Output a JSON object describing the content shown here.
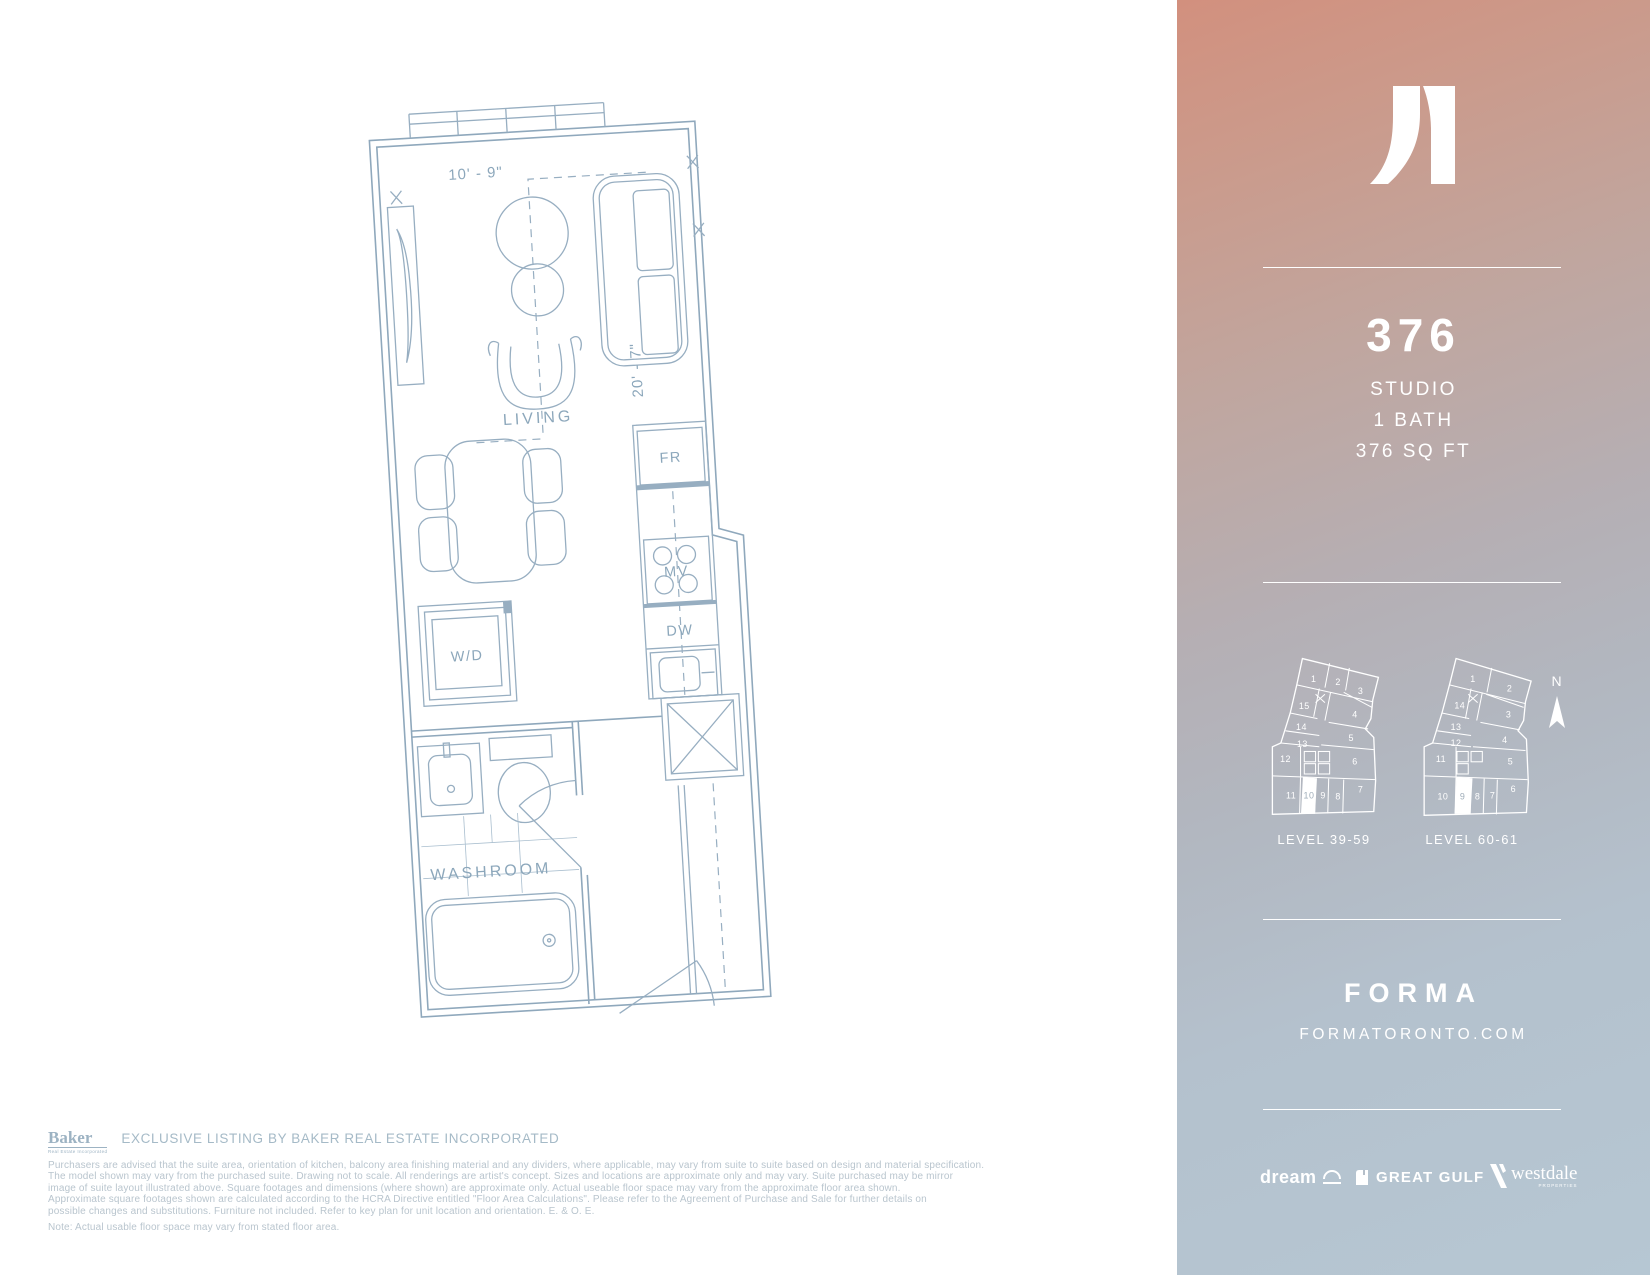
{
  "plan": {
    "living_label": "LIVING",
    "washroom_label": "WASHROOM",
    "wd_label": "W/D",
    "fr_label": "FR",
    "mv_label": "MV",
    "dw_label": "DW",
    "dim_width": "10' - 9\"",
    "dim_depth": "20' - 7\""
  },
  "suite": {
    "number": "376",
    "type": "STUDIO",
    "bath": "1 BATH",
    "area": "376 SQ FT"
  },
  "keyplans": {
    "north_label": "N",
    "left": {
      "label": "LEVEL 39-59",
      "units": [
        {
          "n": "1",
          "x": 54,
          "y": 51
        },
        {
          "n": "2",
          "x": 80,
          "y": 54
        },
        {
          "n": "3",
          "x": 104,
          "y": 64
        },
        {
          "n": "15",
          "x": 44,
          "y": 80
        },
        {
          "n": "4",
          "x": 98,
          "y": 89
        },
        {
          "n": "14",
          "x": 41,
          "y": 102
        },
        {
          "n": "13",
          "x": 42,
          "y": 120
        },
        {
          "n": "5",
          "x": 94,
          "y": 114
        },
        {
          "n": "12",
          "x": 24,
          "y": 136
        },
        {
          "n": "6",
          "x": 98,
          "y": 139
        },
        {
          "n": "11",
          "x": 30,
          "y": 175
        },
        {
          "n": "10",
          "x": 49,
          "y": 175,
          "hl": true
        },
        {
          "n": "9",
          "x": 64,
          "y": 175
        },
        {
          "n": "8",
          "x": 80,
          "y": 176
        },
        {
          "n": "7",
          "x": 104,
          "y": 169
        }
      ]
    },
    "right": {
      "label": "LEVEL 60-61",
      "units": [
        {
          "n": "1",
          "x": 66,
          "y": 51
        },
        {
          "n": "2",
          "x": 105,
          "y": 61
        },
        {
          "n": "14",
          "x": 52,
          "y": 79
        },
        {
          "n": "3",
          "x": 104,
          "y": 89
        },
        {
          "n": "13",
          "x": 48,
          "y": 102
        },
        {
          "n": "12",
          "x": 48,
          "y": 119
        },
        {
          "n": "11",
          "x": 32,
          "y": 136
        },
        {
          "n": "4",
          "x": 100,
          "y": 116
        },
        {
          "n": "5",
          "x": 106,
          "y": 139
        },
        {
          "n": "10",
          "x": 34,
          "y": 176
        },
        {
          "n": "9",
          "x": 55,
          "y": 176,
          "hl": true
        },
        {
          "n": "8",
          "x": 71,
          "y": 176
        },
        {
          "n": "7",
          "x": 87,
          "y": 175
        },
        {
          "n": "6",
          "x": 109,
          "y": 168
        }
      ]
    }
  },
  "brand": {
    "name": "FORMA",
    "url": "FORMATORONTO.COM"
  },
  "partners": {
    "dream": "dream",
    "great_gulf": "GREAT GULF",
    "westdale": "westdale",
    "westdale_sub": "PROPERTIES"
  },
  "footer": {
    "baker": "Baker",
    "baker_sub": "Real Estate Incorporated",
    "exclusive": "EXCLUSIVE LISTING BY BAKER REAL ESTATE INCORPORATED",
    "disclaimer_lines": [
      "Purchasers are advised that the suite area, orientation of kitchen, balcony area finishing material and any dividers, where applicable, may vary from suite to suite based on design and material specification.",
      "The model shown may vary from the purchased suite. Drawing not to scale. All renderings are artist's concept. Sizes and locations are approximate only and may vary. Suite purchased may be mirror",
      "image of suite layout illustrated above. Square footages and dimensions (where shown) are approximate only. Actual useable floor space may vary from the approximate floor area shown.",
      "Approximate square footages shown are calculated according to the HCRA Directive entitled \"Floor Area Calculations\". Please refer to the Agreement of Purchase and Sale for further details on",
      "possible changes and substitutions. Furniture not included. Refer to key plan for unit location and orientation. E. & O. E."
    ],
    "note": "Note: Actual usable floor space may vary from stated floor area."
  },
  "colors": {
    "plan_line": "#97aec1",
    "panel_gradient_top": "#d2907e",
    "panel_gradient_bottom": "#b6c7d3",
    "panel_text": "#ffffff",
    "legal_text": "#b9c5ce"
  }
}
